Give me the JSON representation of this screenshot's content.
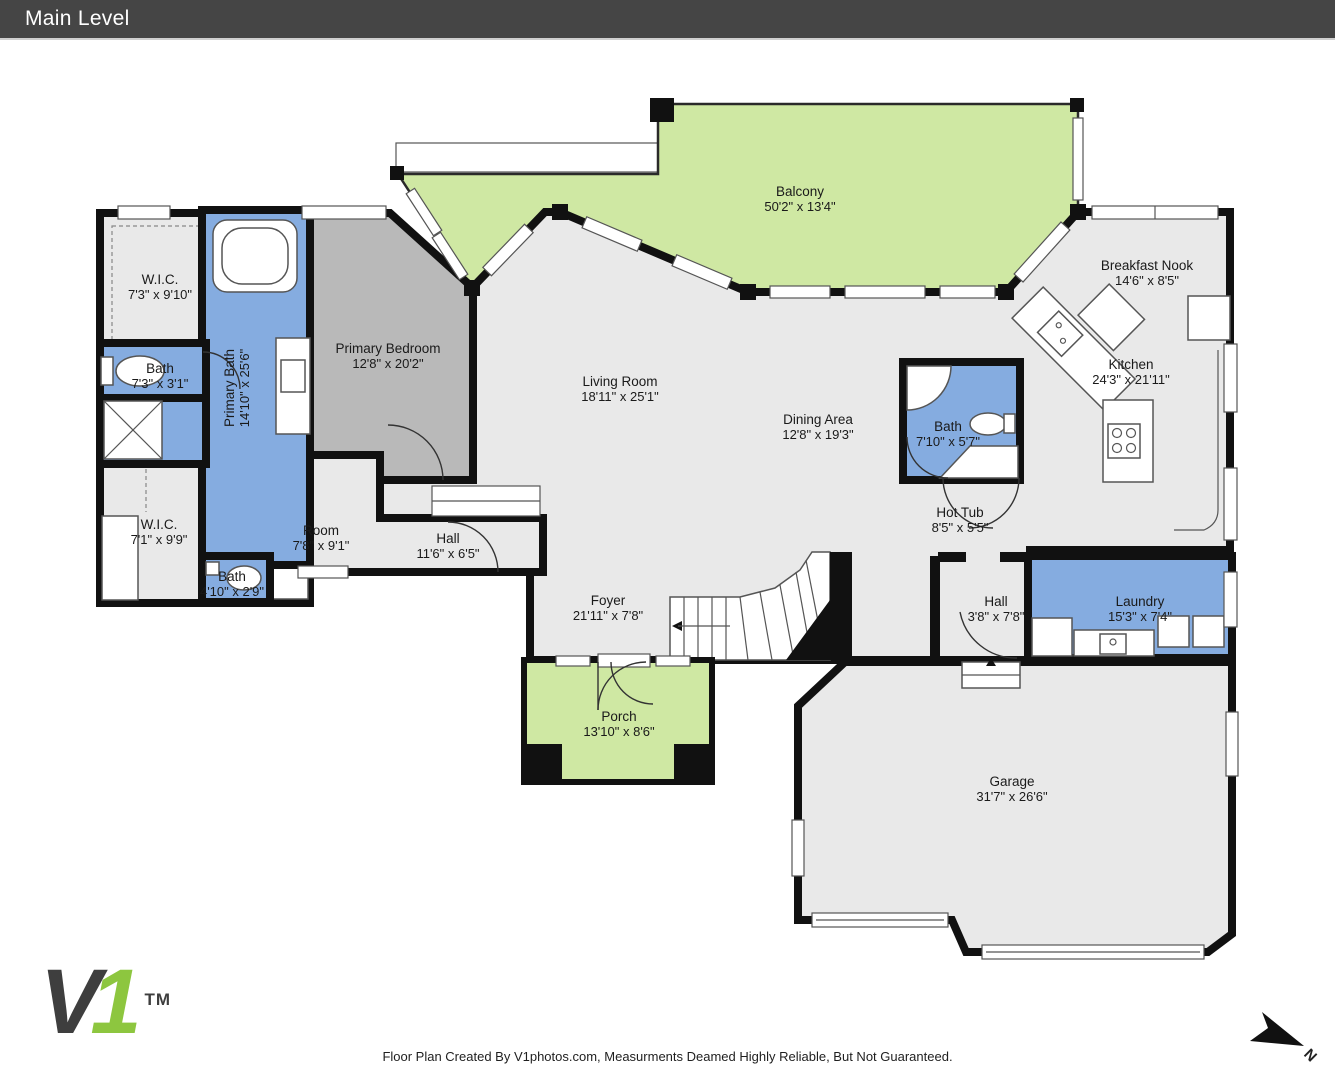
{
  "header": {
    "title": "Main Level"
  },
  "rooms": [
    {
      "name": "Balcony",
      "dims": "50'2\" x 13'4\""
    },
    {
      "name": "Breakfast Nook",
      "dims": "14'6\" x 8'5\""
    },
    {
      "name": "Kitchen",
      "dims": "24'3\" x 21'11\""
    },
    {
      "name": "W.I.C.",
      "dims": "7'3\" x 9'10\""
    },
    {
      "name": "Bath",
      "dims": "7'3\" x 3'1\""
    },
    {
      "name": "Primary Bath",
      "dims": "14'10\" x 25'6\""
    },
    {
      "name": "Primary Bedroom",
      "dims": "12'8\" x 20'2\""
    },
    {
      "name": "Living Room",
      "dims": "18'11\" x 25'1\""
    },
    {
      "name": "Dining Area",
      "dims": "12'8\" x 19'3\""
    },
    {
      "name": "Bath",
      "dims": "7'10\" x 5'7\""
    },
    {
      "name": "Hot Tub",
      "dims": "8'5\" x 5'5\""
    },
    {
      "name": "W.I.C.",
      "dims": "7'1\" x 9'9\""
    },
    {
      "name": "Room",
      "dims": "7'8\" x 9'1\""
    },
    {
      "name": "Hall",
      "dims": "11'6\" x 6'5\""
    },
    {
      "name": "Bath",
      "dims": "4'10\" x 2'9\""
    },
    {
      "name": "Foyer",
      "dims": "21'11\" x 7'8\""
    },
    {
      "name": "Hall",
      "dims": "3'8\" x 7'8\""
    },
    {
      "name": "Laundry",
      "dims": "15'3\" x 7'4\""
    },
    {
      "name": "Porch",
      "dims": "13'10\" x 8'6\""
    },
    {
      "name": "Garage",
      "dims": "31'7\" x 26'6\""
    }
  ],
  "compass": {
    "label": "N"
  },
  "logo": {
    "v": "V",
    "one": "1",
    "tm": "TM"
  },
  "footer": {
    "credit": "Floor Plan Created By V1photos.com, Measurments Deamed Highly Reliable, But Not Guaranteed."
  },
  "colors": {
    "header_bg": "#454545",
    "wall": "#111111",
    "floor_gray": "#e9e9e9",
    "bedroom_gray": "#b9b9b9",
    "outdoor_green": "#cfe8a3",
    "wet_room_blue": "#85ace0",
    "logo_green": "#8dc63f",
    "logo_gray": "#3e3e3e"
  }
}
